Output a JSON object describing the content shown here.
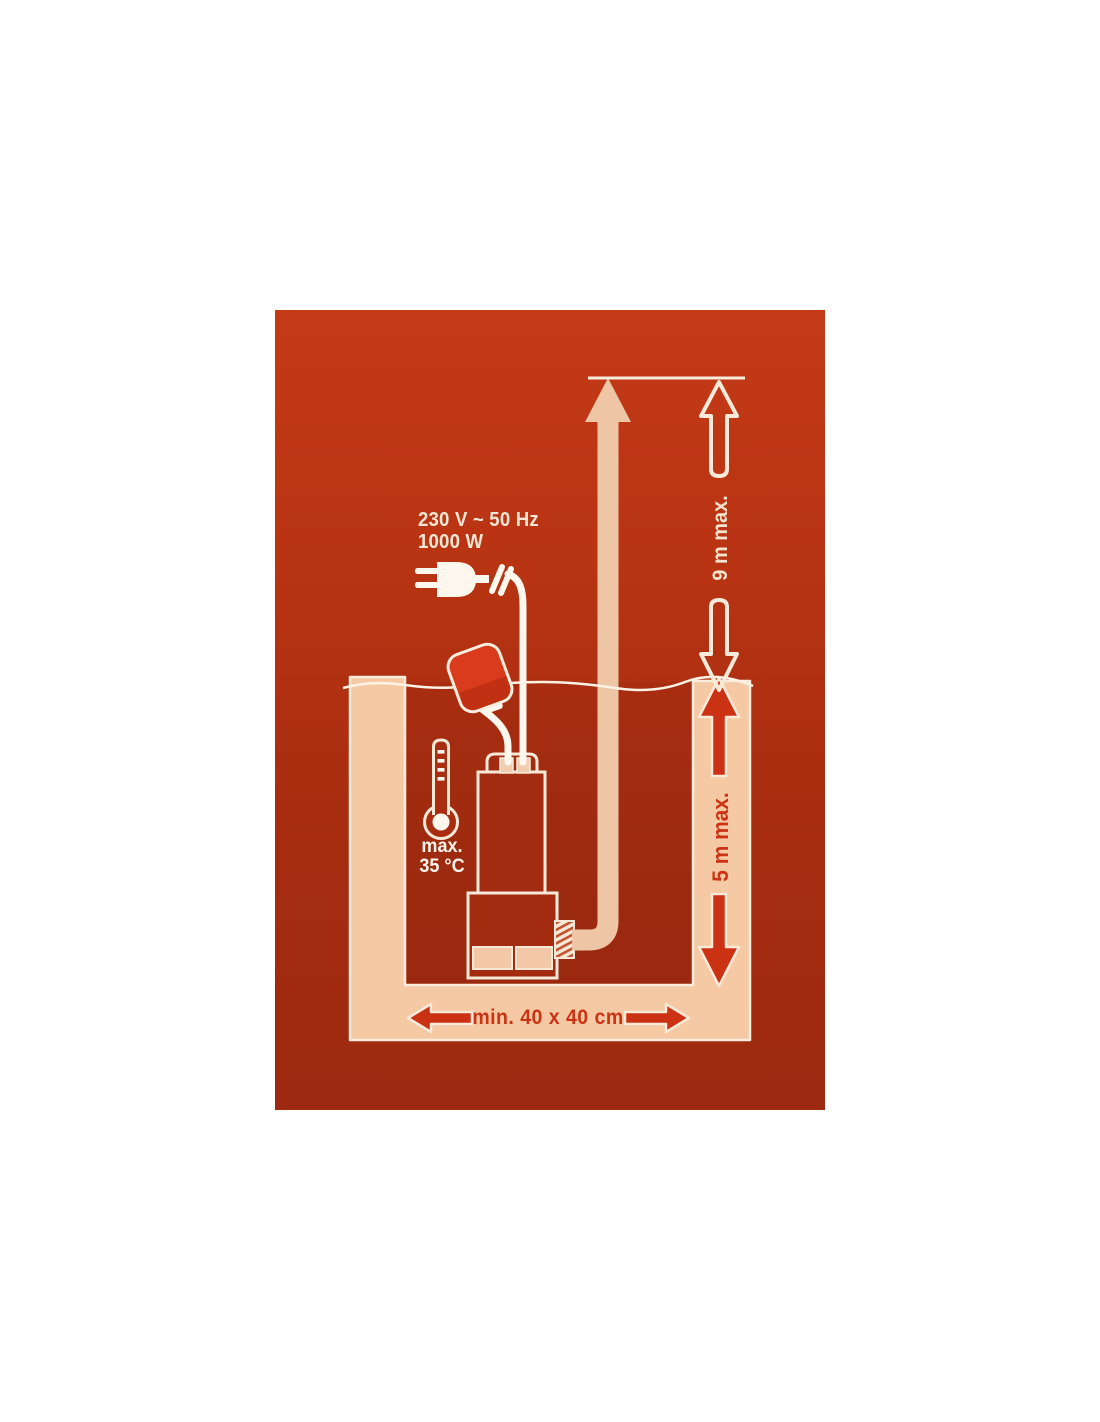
{
  "diagram": {
    "type": "product-installation-diagram",
    "subject": "submersible pump installed in a pit with float switch, discharge pipe and dimension arrows",
    "labels": {
      "power_line1": "230 V ~ 50 Hz",
      "power_line2": "1000 W",
      "temp_line1": "max.",
      "temp_line2": "35 °C",
      "delivery_head": "9 m max.",
      "immersion_depth": "5 m max.",
      "pit_min_size": "min. 40 x 40 cm"
    },
    "icons": {
      "plug": "power-plug-icon",
      "cable_break": "cable-break-icon",
      "thermometer": "thermometer-icon",
      "float": "float-switch",
      "pump": "submersible-pump",
      "pipe": "discharge-pipe-arrow",
      "water": "water-level-line",
      "dimension_arrows": [
        "up-arrow-outline",
        "down-arrow-outline",
        "up-arrow-red",
        "down-arrow-red",
        "left-arrow-red",
        "right-arrow-red"
      ]
    },
    "colors": {
      "background_top": "#c43a17",
      "background_bottom": "#9c2910",
      "pit_wall_beige": "#f5c9a4",
      "pipe_beige": "#eec5a5",
      "outline_cream": "#f8ecdc",
      "accent_red": "#cc3315",
      "float_red_top": "#d93b1c",
      "float_red_bottom": "#c23013",
      "white": "#fdf7ee"
    }
  }
}
